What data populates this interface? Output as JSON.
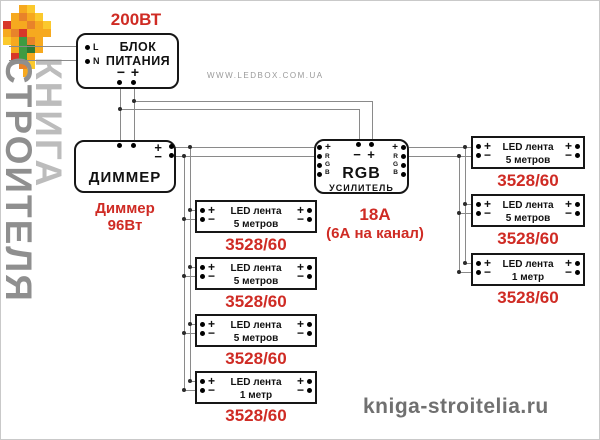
{
  "watermark": {
    "word1": "КНИГА",
    "word2": "СТРОИТЕЛЯ"
  },
  "links": {
    "ledbox": "WWW.LEDBOX.COM.UA",
    "kniga": "kniga-stroitelia.ru"
  },
  "symbols": {
    "plus": "+",
    "minus": "−"
  },
  "psu": {
    "power": "200ВТ",
    "title1": "БЛОК",
    "title2": "ПИТАНИЯ",
    "l": "L",
    "n": "N",
    "minus": "−",
    "plus": "+"
  },
  "dimmer": {
    "title": "ДИММЕР",
    "plus": "+",
    "minus": "−",
    "cap1": "Диммер",
    "cap2": "96Вт"
  },
  "amp": {
    "title": "RGB",
    "subtitle": "УСИЛИТЕЛЬ",
    "minus": "−",
    "plus": "+",
    "ch": [
      "+",
      "R",
      "G",
      "B"
    ],
    "cap1": "18А",
    "cap2": "(6А на канал)"
  },
  "strips": {
    "middle": [
      {
        "l1": "LED лента",
        "l2": "5 метров",
        "model": "3528/60"
      },
      {
        "l1": "LED лента",
        "l2": "5 метров",
        "model": "3528/60"
      },
      {
        "l1": "LED лента",
        "l2": "5 метров",
        "model": "3528/60"
      },
      {
        "l1": "LED лента",
        "l2": "1 метр",
        "model": "3528/60"
      }
    ],
    "right": [
      {
        "l1": "LED лента",
        "l2": "5 метров",
        "model": "3528/60"
      },
      {
        "l1": "LED лента",
        "l2": "5 метров",
        "model": "3528/60"
      },
      {
        "l1": "LED лента",
        "l2": "1 метр",
        "model": "3528/60"
      }
    ]
  },
  "colors": {
    "accent_red": "#cf2b24",
    "wire_gray": "#8a8a8a",
    "watermark_gray": "#8f8f8f"
  }
}
